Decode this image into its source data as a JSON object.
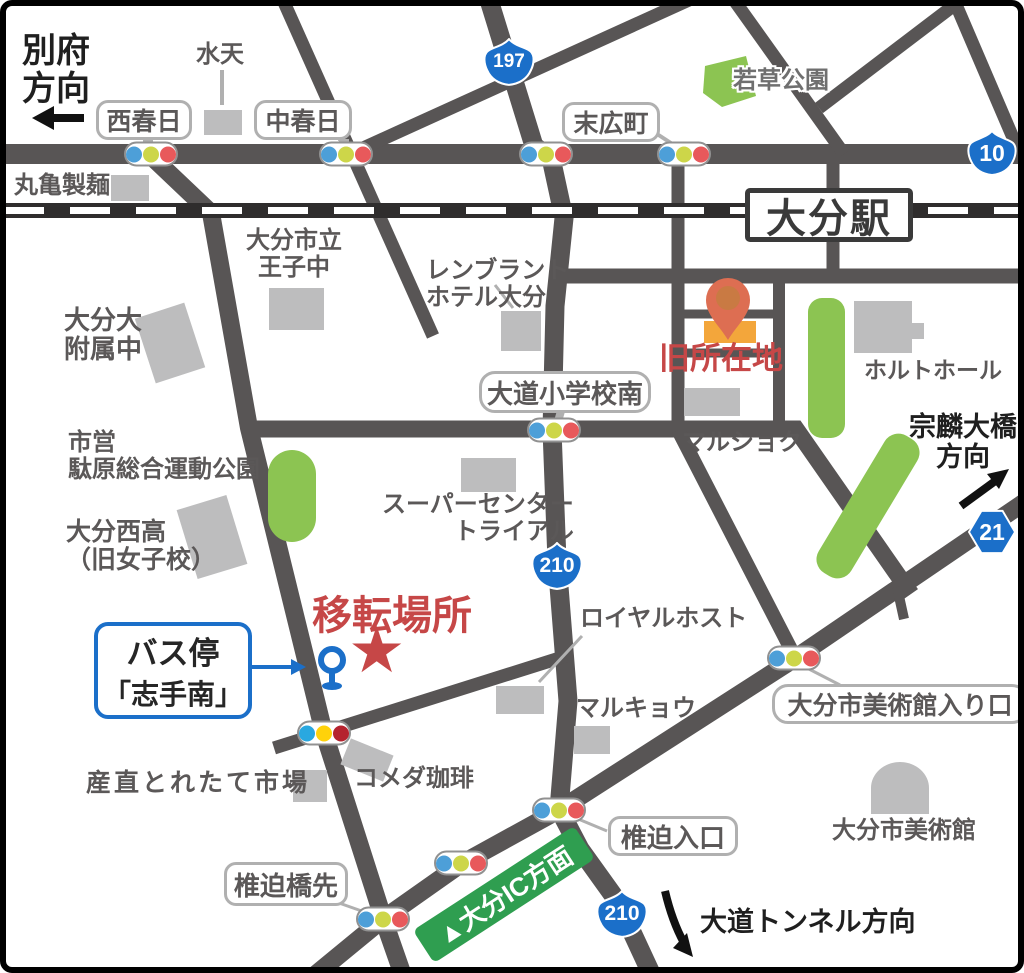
{
  "map_type": "access-map",
  "markers": {
    "relocation": "移転場所",
    "former_site": "旧所在地"
  },
  "station": {
    "oita": "大分駅"
  },
  "shields": {
    "r197": "197",
    "r10": "10",
    "r210_mid": "210",
    "r210_south": "210",
    "r21": "21"
  },
  "boxed": {
    "nishikasuga": "西春日",
    "nakakasuga": "中春日",
    "suehirocho": "末広町",
    "omichi_minami": "大道小学校南",
    "museum_entrance": "大分市美術館入り口",
    "shiisako_entrance": "椎迫入口",
    "shiisako_bridge": "椎迫橋先"
  },
  "bus_stop": {
    "line1": "バス停",
    "line2": "「志手南」"
  },
  "directions": {
    "beppu_line1": "別府",
    "beppu_line2": "方向",
    "sorin_line1": "宗麟大橋",
    "sorin_line2": "方向",
    "tunnel": "大道トンネル方向",
    "ic_banner": "▲大分IC方面"
  },
  "places": {
    "suiten": "水天",
    "marugame": "丸亀製麺",
    "wakakusa_park": "若草公園",
    "oji_line1": "大分市立",
    "oji_line2": "王子中",
    "rembrandt_line1": "レンブラント",
    "rembrandt_line2": "ホテル大分",
    "fuzoku_line1": "大分大",
    "fuzoku_line2": "附属中",
    "holt_hall": "ホルトホール",
    "shiei_line1": "市営",
    "shiei_line2": "駄原総合運動公園",
    "trial_line1": "スーパーセンター",
    "trial_line2": "トライアル",
    "nishi_high_line1": "大分西高",
    "nishi_high_line2": "（旧女子校）",
    "marushoku": "マルショク",
    "royal_host": "ロイヤルホスト",
    "marukyo": "マルキョウ",
    "museum": "大分市美術館",
    "sanchoku": "産直とれたて市場",
    "komeda": "コメダ珈琲"
  },
  "colors": {
    "road": "#585555",
    "building": "#bdbdbe",
    "park_green": "#8cc452",
    "accent_red": "#c64747",
    "route_blue": "#1b6fc9",
    "banner_green": "#2f9e50",
    "pin_orange": "#dd6e52",
    "old_site_building": "#f3a63b",
    "signal_blue": "#4d9fd8",
    "signal_yellow": "#cdd649",
    "signal_red": "#e8595b"
  }
}
